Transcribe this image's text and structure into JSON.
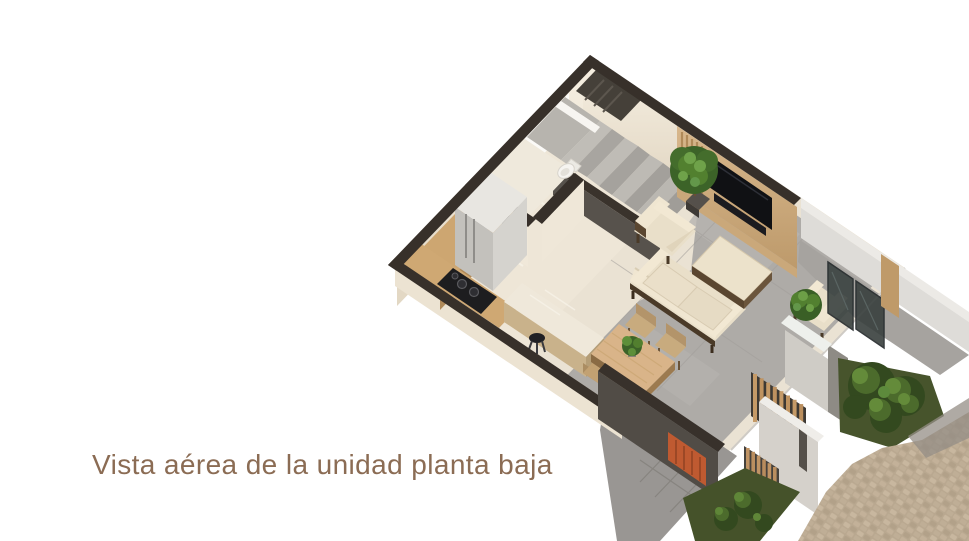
{
  "page": {
    "background_color": "#ffffff",
    "width_px": 969,
    "height_px": 541
  },
  "caption": {
    "text": "Vista aérea de la unidad planta baja",
    "color": "#8b6c54"
  },
  "scene": {
    "type": "3d-floorplan-aerial-render",
    "palette": {
      "wall_top_dark": "#37302a",
      "wall_face_cream": "#efe7d8",
      "floor_marble_cream": "#ece4d5",
      "floor_concrete_gray": "#aeaba7",
      "court_gray": "#999693",
      "wood_counter": "#cda671",
      "wood_table": "#d9b489",
      "wood_slats": "#c59a67",
      "upholstery_cream": "#e9dfc9",
      "frame_wood_dark": "#4a3a28",
      "tv_black": "#101114",
      "plant_green_dark": "#33491f",
      "plant_green_mid": "#4c6b2c",
      "plant_green_light": "#648b3a",
      "accent_terracotta": "#bf5a31",
      "stucco_light": "#d6d2cc",
      "fence_light": "#dedcd8",
      "grass_olive": "#47542c",
      "paver_beige": "#b9a890"
    },
    "elements": [
      "staircase",
      "upper-flight-void",
      "bathroom-toilet",
      "bathroom-vanity",
      "kitchen-counter",
      "kitchen-sink",
      "cooktop",
      "refrigerator",
      "kitchen-island",
      "bar-stool",
      "dining-table",
      "dining-chairs",
      "table-plant",
      "sofa",
      "coffee-table",
      "armchair-near-stairs",
      "armchair-near-window",
      "tv-media-wall",
      "indoor-plant",
      "glass-window-panes",
      "planter-pillar",
      "entry-wood-slats",
      "terracotta-accent-wall",
      "courtyard-dark-wall",
      "stucco-wall-slit-window",
      "boundary-fence",
      "garden-bushes",
      "grass-patches",
      "paver-driveway",
      "entry-path"
    ]
  }
}
